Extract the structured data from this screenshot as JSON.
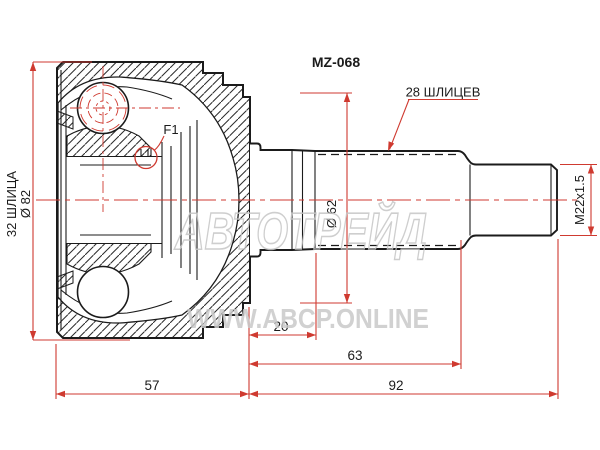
{
  "drawing": {
    "part_number": "MZ-068",
    "labels": {
      "inner_spline_count": "32 ШЛИЦА",
      "housing_diameter": "Ø 82",
      "shaft_spline_count": "28 ШЛИЦЕВ",
      "flange_diameter": "Ø 62",
      "thread_spec": "M22x1.5",
      "detail_marker": "F1"
    },
    "dimensions": {
      "housing_length_mm": "57",
      "boot_groove_length_mm": "20",
      "spline_section_length_mm": "63",
      "shaft_length_mm": "92"
    },
    "watermark": {
      "brand": "АВТОТРЕЙД",
      "site": "WWW.ABCP.ONLINE"
    },
    "colors": {
      "line": "#1b1b1b",
      "dimension": "#cf3a30",
      "watermark": "#c6c6c6",
      "background": "#ffffff"
    }
  }
}
